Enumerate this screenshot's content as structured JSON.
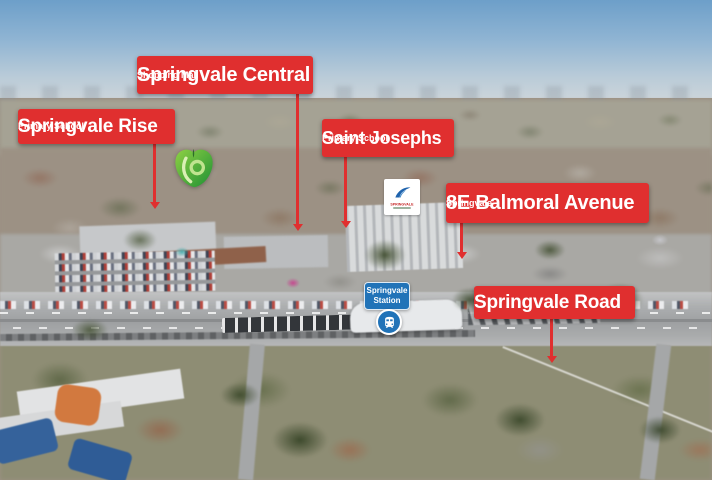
{
  "colors": {
    "label_red": "#e02f2f",
    "station_blue": "#2173b8",
    "label_text": "#ffffff",
    "woolworths_green": "#3da232",
    "logo_blue": "#1f63ad"
  },
  "callouts": {
    "springvale_central": {
      "title": "Springvale Central",
      "subtitle": "Shopping Mall"
    },
    "springvale_rise": {
      "title": "Springvale Rise",
      "subtitle": "Primary School"
    },
    "saint_josephs": {
      "title": "Saint Josephs",
      "subtitle": "Primary School"
    },
    "property": {
      "title": "8E Balmoral Avenue",
      "subtitle": "Springvale"
    },
    "springvale_road": {
      "title": "Springvale Road"
    }
  },
  "station": {
    "line1": "Springvale",
    "line2": "Station"
  },
  "building_logo": {
    "text": "SPRINGVALE"
  },
  "icons": {
    "train": "train-front-in-blue-circle",
    "woolworths": "woolworths-apple-w",
    "pointer": "red-arrow-down"
  }
}
